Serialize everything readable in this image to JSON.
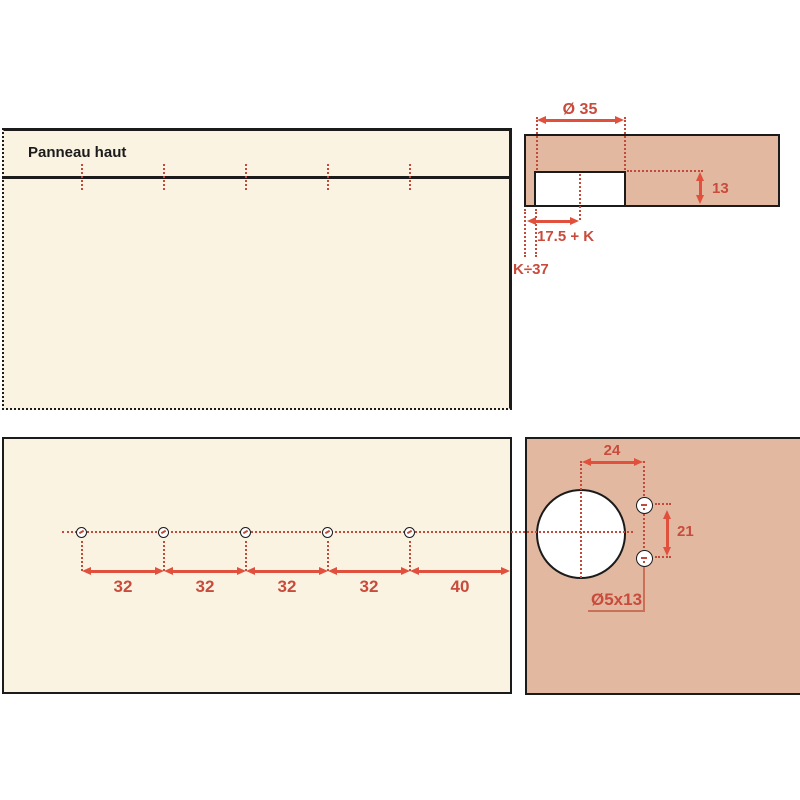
{
  "colors": {
    "cream": "#FAF3E2",
    "salmon": "#E2B8A1",
    "ink": "#1B1B1B",
    "red": "#E0503C",
    "red_text": "#C94B3C",
    "dot_red": "#C14A3A",
    "leader": "#CA7058"
  },
  "top_panel": {
    "label": "Panneau haut"
  },
  "edge_section": {
    "diameter_label": "Ø 35",
    "depth_label": "13",
    "offset_label": "17.5 + K",
    "k_label": "K÷37"
  },
  "bottom_panel": {
    "spacing_labels": [
      "32",
      "32",
      "32",
      "32",
      "40"
    ]
  },
  "face_panel": {
    "offset_label": "24",
    "pitch_label": "21",
    "screw_spec_label": "Ø5x13"
  }
}
